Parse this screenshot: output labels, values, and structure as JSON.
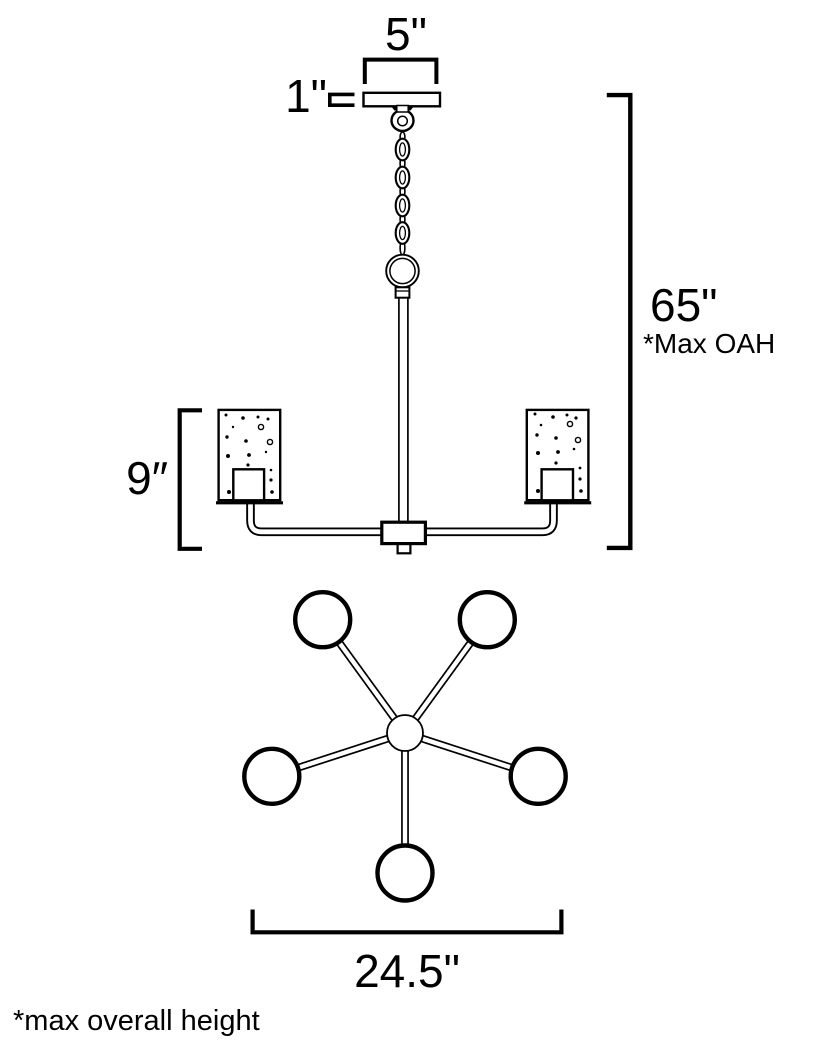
{
  "page": {
    "background_color": "#ffffff",
    "line_color": "#000000"
  },
  "side_view": {
    "canopy_width_label": "5\"",
    "canopy_height_label": "1\"",
    "shade_height_label": "9″",
    "overall_height_label": "65\"",
    "overall_height_note": "*Max OAH"
  },
  "top_view": {
    "spread_label": "24.5\""
  },
  "footnote": "*max overall height"
}
